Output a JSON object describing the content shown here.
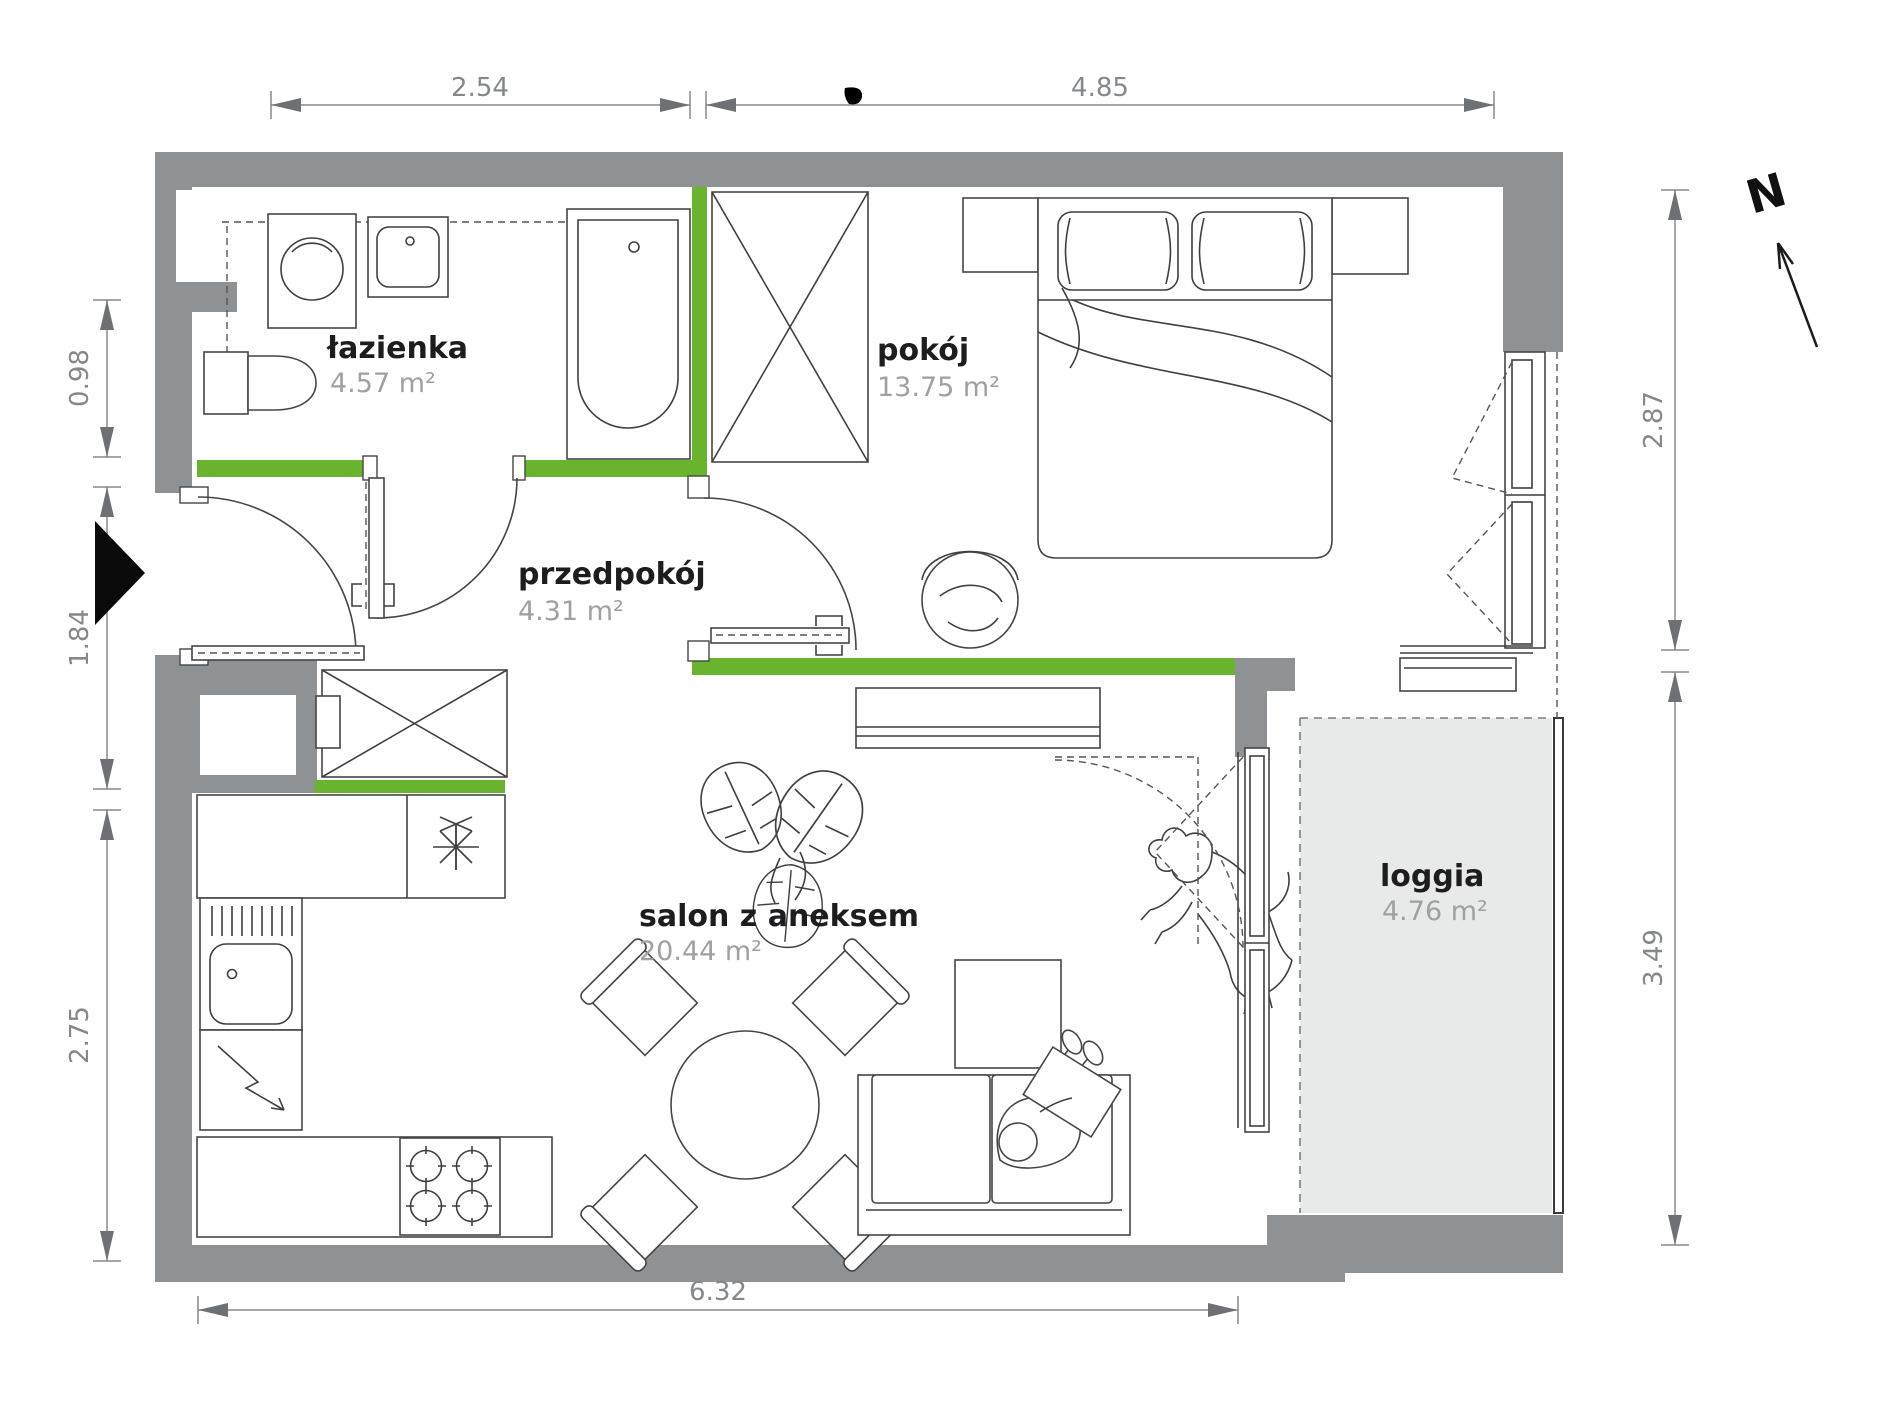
{
  "plan": {
    "rooms": [
      {
        "key": "lazienka",
        "name": "łazienka",
        "area": "4.57 m²"
      },
      {
        "key": "pokoj",
        "name": "pokój",
        "area": "13.75 m²"
      },
      {
        "key": "przedpokoj",
        "name": "przedpokój",
        "area": "4.31 m²"
      },
      {
        "key": "salon",
        "name": "salon z aneksem",
        "area": "20.44 m²"
      },
      {
        "key": "loggia",
        "name": "loggia",
        "area": "4.76 m²"
      }
    ],
    "dimensions": {
      "top": [
        "2.54",
        "4.85"
      ],
      "bottom": [
        "6.32"
      ],
      "left": [
        "0.98",
        "1.84",
        "2.75"
      ],
      "right": [
        "2.87",
        "3.49"
      ]
    },
    "compass": {
      "label": "N"
    },
    "colors": {
      "wall": "#8f9295",
      "accent_green": "#69b32e",
      "loggia_floor": "#e8e9e9",
      "dimension": "#85888b",
      "label_dark": "#1d1d1f",
      "label_muted": "#9ea0a2"
    }
  }
}
